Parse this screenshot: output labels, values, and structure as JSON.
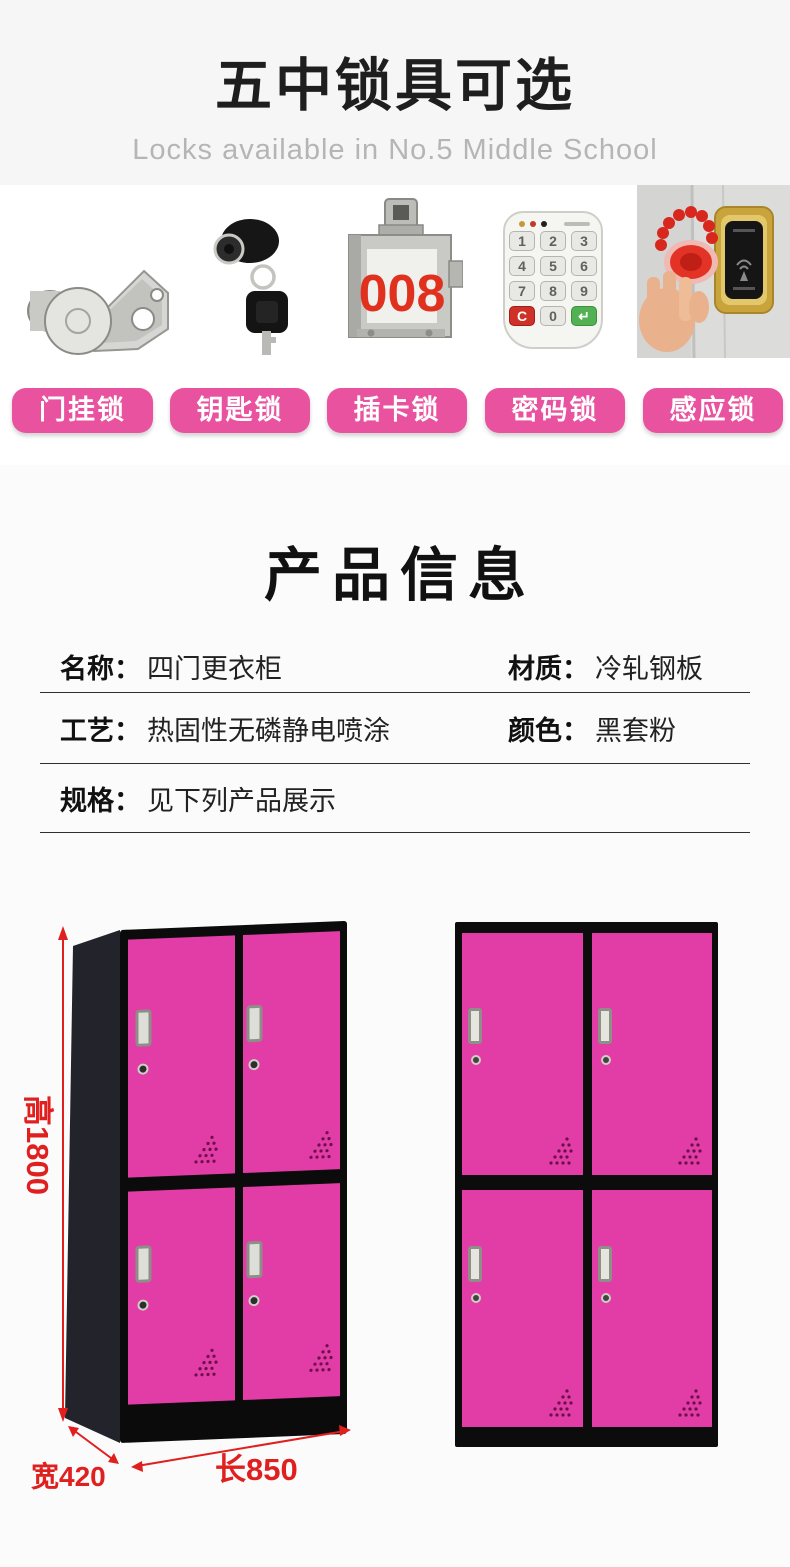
{
  "header": {
    "title": "五中锁具可选",
    "subtitle": "Locks available in No.5 Middle School"
  },
  "lock_section": {
    "buttons": [
      {
        "label": "门挂锁"
      },
      {
        "label": "钥匙锁"
      },
      {
        "label": "插卡锁"
      },
      {
        "label": "密码锁"
      },
      {
        "label": "感应锁"
      }
    ],
    "card_lock_number": "008",
    "keypad_keys": [
      "1",
      "2",
      "3",
      "4",
      "5",
      "6",
      "7",
      "8",
      "9",
      "C",
      "0",
      "↵"
    ]
  },
  "product_info": {
    "title": "产品信息",
    "rows": [
      {
        "cells": [
          {
            "label": "名称：",
            "value": "四门更衣柜"
          },
          {
            "label": "材质：",
            "value": "冷轧钢板"
          }
        ]
      },
      {
        "cells": [
          {
            "label": "工艺：",
            "value": "热固性无磷静电喷涂"
          },
          {
            "label": "颜色：",
            "value": "黑套粉"
          }
        ]
      },
      {
        "cells": [
          {
            "label": "规格：",
            "value": "见下列产品展示"
          }
        ]
      }
    ]
  },
  "lockers": {
    "dimensions": {
      "height": "高1800",
      "width": "宽420",
      "length": "长850"
    }
  },
  "colors": {
    "pink_button": "#e8529f",
    "pink_door": "#e23ca6",
    "dimension_red": "#e01f1f",
    "card_number_red": "#e0301e"
  }
}
